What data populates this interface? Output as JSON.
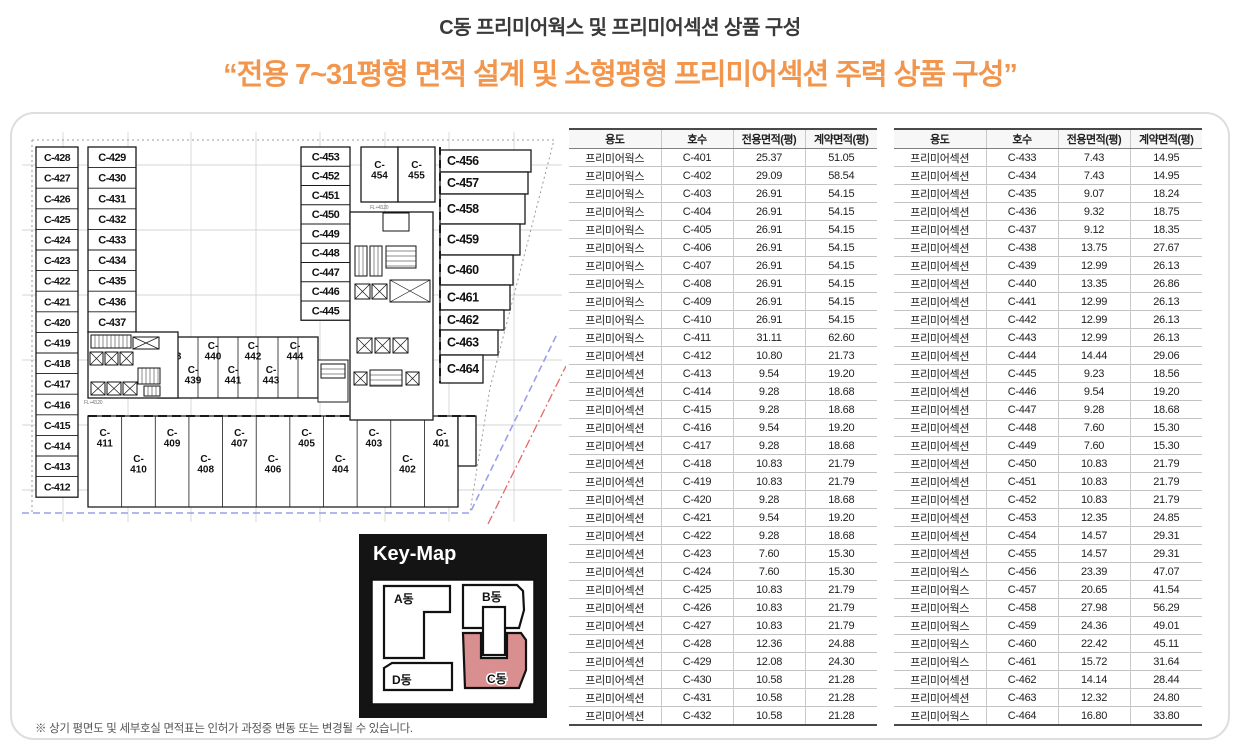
{
  "page": {
    "title": "C동 프리미어웍스 및 프리미어섹션 상품 구성",
    "subtitle": "“전용 7~31평형 면적 설계 및 소형평형 프리미어섹션 주력 상품 구성”",
    "footnote": "※ 상기 평면도 및 세부호실 면적표는 인허가 과정중 변동 또는 변경될 수 있습니다.",
    "accent_orange": "#F2964E",
    "keymap_highlight": "#D98F8F"
  },
  "floorplan": {
    "left_outer_column": [
      "C-428",
      "C-427",
      "C-426",
      "C-425",
      "C-424",
      "C-423",
      "C-422",
      "C-421",
      "C-420",
      "C-419",
      "C-418",
      "C-417",
      "C-416",
      "C-415",
      "C-414",
      "C-413",
      "C-412"
    ],
    "left_inner_column": [
      "C-429",
      "C-430",
      "C-431",
      "C-432",
      "C-433",
      "C-434",
      "C-435",
      "C-436",
      "C-437"
    ],
    "center_upper_row": [
      "C-438",
      "C-440",
      "C-442",
      "C-444"
    ],
    "center_lower_row": [
      "C-439",
      "C-441",
      "C-443"
    ],
    "right_inner_column": [
      "C-453",
      "C-452",
      "C-451",
      "C-450",
      "C-449",
      "C-448",
      "C-447",
      "C-446",
      "C-445"
    ],
    "top_pair": [
      "C-454",
      "C-455"
    ],
    "right_outer_column": [
      "C-456",
      "C-457",
      "C-458",
      "C-459",
      "C-460",
      "C-461",
      "C-462",
      "C-463",
      "C-464"
    ],
    "bottom_upper_row": [
      "C-411",
      "C-409",
      "C-407",
      "C-405",
      "C-403",
      "C-401"
    ],
    "bottom_lower_row": [
      "C-410",
      "C-408",
      "C-406",
      "C-404",
      "C-402"
    ],
    "level_label": "FL +43.20"
  },
  "keymap": {
    "title": "Key-Map",
    "a": "A동",
    "b": "B동",
    "c": "C동",
    "d": "D동",
    "highlighted": "C동"
  },
  "tables": {
    "headers": [
      "용도",
      "호수",
      "전용면적(평)",
      "계약면적(평)"
    ],
    "left_rows": [
      [
        "프리미어웍스",
        "C-401",
        "25.37",
        "51.05"
      ],
      [
        "프리미어웍스",
        "C-402",
        "29.09",
        "58.54"
      ],
      [
        "프리미어웍스",
        "C-403",
        "26.91",
        "54.15"
      ],
      [
        "프리미어웍스",
        "C-404",
        "26.91",
        "54.15"
      ],
      [
        "프리미어웍스",
        "C-405",
        "26.91",
        "54.15"
      ],
      [
        "프리미어웍스",
        "C-406",
        "26.91",
        "54.15"
      ],
      [
        "프리미어웍스",
        "C-407",
        "26.91",
        "54.15"
      ],
      [
        "프리미어웍스",
        "C-408",
        "26.91",
        "54.15"
      ],
      [
        "프리미어웍스",
        "C-409",
        "26.91",
        "54.15"
      ],
      [
        "프리미어웍스",
        "C-410",
        "26.91",
        "54.15"
      ],
      [
        "프리미어웍스",
        "C-411",
        "31.11",
        "62.60"
      ],
      [
        "프리미어섹션",
        "C-412",
        "10.80",
        "21.73"
      ],
      [
        "프리미어섹션",
        "C-413",
        "9.54",
        "19.20"
      ],
      [
        "프리미어섹션",
        "C-414",
        "9.28",
        "18.68"
      ],
      [
        "프리미어섹션",
        "C-415",
        "9.28",
        "18.68"
      ],
      [
        "프리미어섹션",
        "C-416",
        "9.54",
        "19.20"
      ],
      [
        "프리미어섹션",
        "C-417",
        "9.28",
        "18.68"
      ],
      [
        "프리미어섹션",
        "C-418",
        "10.83",
        "21.79"
      ],
      [
        "프리미어섹션",
        "C-419",
        "10.83",
        "21.79"
      ],
      [
        "프리미어섹션",
        "C-420",
        "9.28",
        "18.68"
      ],
      [
        "프리미어섹션",
        "C-421",
        "9.54",
        "19.20"
      ],
      [
        "프리미어섹션",
        "C-422",
        "9.28",
        "18.68"
      ],
      [
        "프리미어섹션",
        "C-423",
        "7.60",
        "15.30"
      ],
      [
        "프리미어섹션",
        "C-424",
        "7.60",
        "15.30"
      ],
      [
        "프리미어섹션",
        "C-425",
        "10.83",
        "21.79"
      ],
      [
        "프리미어섹션",
        "C-426",
        "10.83",
        "21.79"
      ],
      [
        "프리미어섹션",
        "C-427",
        "10.83",
        "21.79"
      ],
      [
        "프리미어섹션",
        "C-428",
        "12.36",
        "24.88"
      ],
      [
        "프리미어섹션",
        "C-429",
        "12.08",
        "24.30"
      ],
      [
        "프리미어섹션",
        "C-430",
        "10.58",
        "21.28"
      ],
      [
        "프리미어섹션",
        "C-431",
        "10.58",
        "21.28"
      ],
      [
        "프리미어섹션",
        "C-432",
        "10.58",
        "21.28"
      ]
    ],
    "right_rows": [
      [
        "프리미어섹션",
        "C-433",
        "7.43",
        "14.95"
      ],
      [
        "프리미어섹션",
        "C-434",
        "7.43",
        "14.95"
      ],
      [
        "프리미어섹션",
        "C-435",
        "9.07",
        "18.24"
      ],
      [
        "프리미어섹션",
        "C-436",
        "9.32",
        "18.75"
      ],
      [
        "프리미어섹션",
        "C-437",
        "9.12",
        "18.35"
      ],
      [
        "프리미어섹션",
        "C-438",
        "13.75",
        "27.67"
      ],
      [
        "프리미어섹션",
        "C-439",
        "12.99",
        "26.13"
      ],
      [
        "프리미어섹션",
        "C-440",
        "13.35",
        "26.86"
      ],
      [
        "프리미어섹션",
        "C-441",
        "12.99",
        "26.13"
      ],
      [
        "프리미어섹션",
        "C-442",
        "12.99",
        "26.13"
      ],
      [
        "프리미어섹션",
        "C-443",
        "12.99",
        "26.13"
      ],
      [
        "프리미어섹션",
        "C-444",
        "14.44",
        "29.06"
      ],
      [
        "프리미어섹션",
        "C-445",
        "9.23",
        "18.56"
      ],
      [
        "프리미어섹션",
        "C-446",
        "9.54",
        "19.20"
      ],
      [
        "프리미어섹션",
        "C-447",
        "9.28",
        "18.68"
      ],
      [
        "프리미어섹션",
        "C-448",
        "7.60",
        "15.30"
      ],
      [
        "프리미어섹션",
        "C-449",
        "7.60",
        "15.30"
      ],
      [
        "프리미어섹션",
        "C-450",
        "10.83",
        "21.79"
      ],
      [
        "프리미어섹션",
        "C-451",
        "10.83",
        "21.79"
      ],
      [
        "프리미어섹션",
        "C-452",
        "10.83",
        "21.79"
      ],
      [
        "프리미어섹션",
        "C-453",
        "12.35",
        "24.85"
      ],
      [
        "프리미어섹션",
        "C-454",
        "14.57",
        "29.31"
      ],
      [
        "프리미어섹션",
        "C-455",
        "14.57",
        "29.31"
      ],
      [
        "프리미어웍스",
        "C-456",
        "23.39",
        "47.07"
      ],
      [
        "프리미어웍스",
        "C-457",
        "20.65",
        "41.54"
      ],
      [
        "프리미어웍스",
        "C-458",
        "27.98",
        "56.29"
      ],
      [
        "프리미어웍스",
        "C-459",
        "24.36",
        "49.01"
      ],
      [
        "프리미어웍스",
        "C-460",
        "22.42",
        "45.11"
      ],
      [
        "프리미어웍스",
        "C-461",
        "15.72",
        "31.64"
      ],
      [
        "프리미어섹션",
        "C-462",
        "14.14",
        "28.44"
      ],
      [
        "프리미어섹션",
        "C-463",
        "12.32",
        "24.80"
      ],
      [
        "프리미어웍스",
        "C-464",
        "16.80",
        "33.80"
      ]
    ]
  }
}
